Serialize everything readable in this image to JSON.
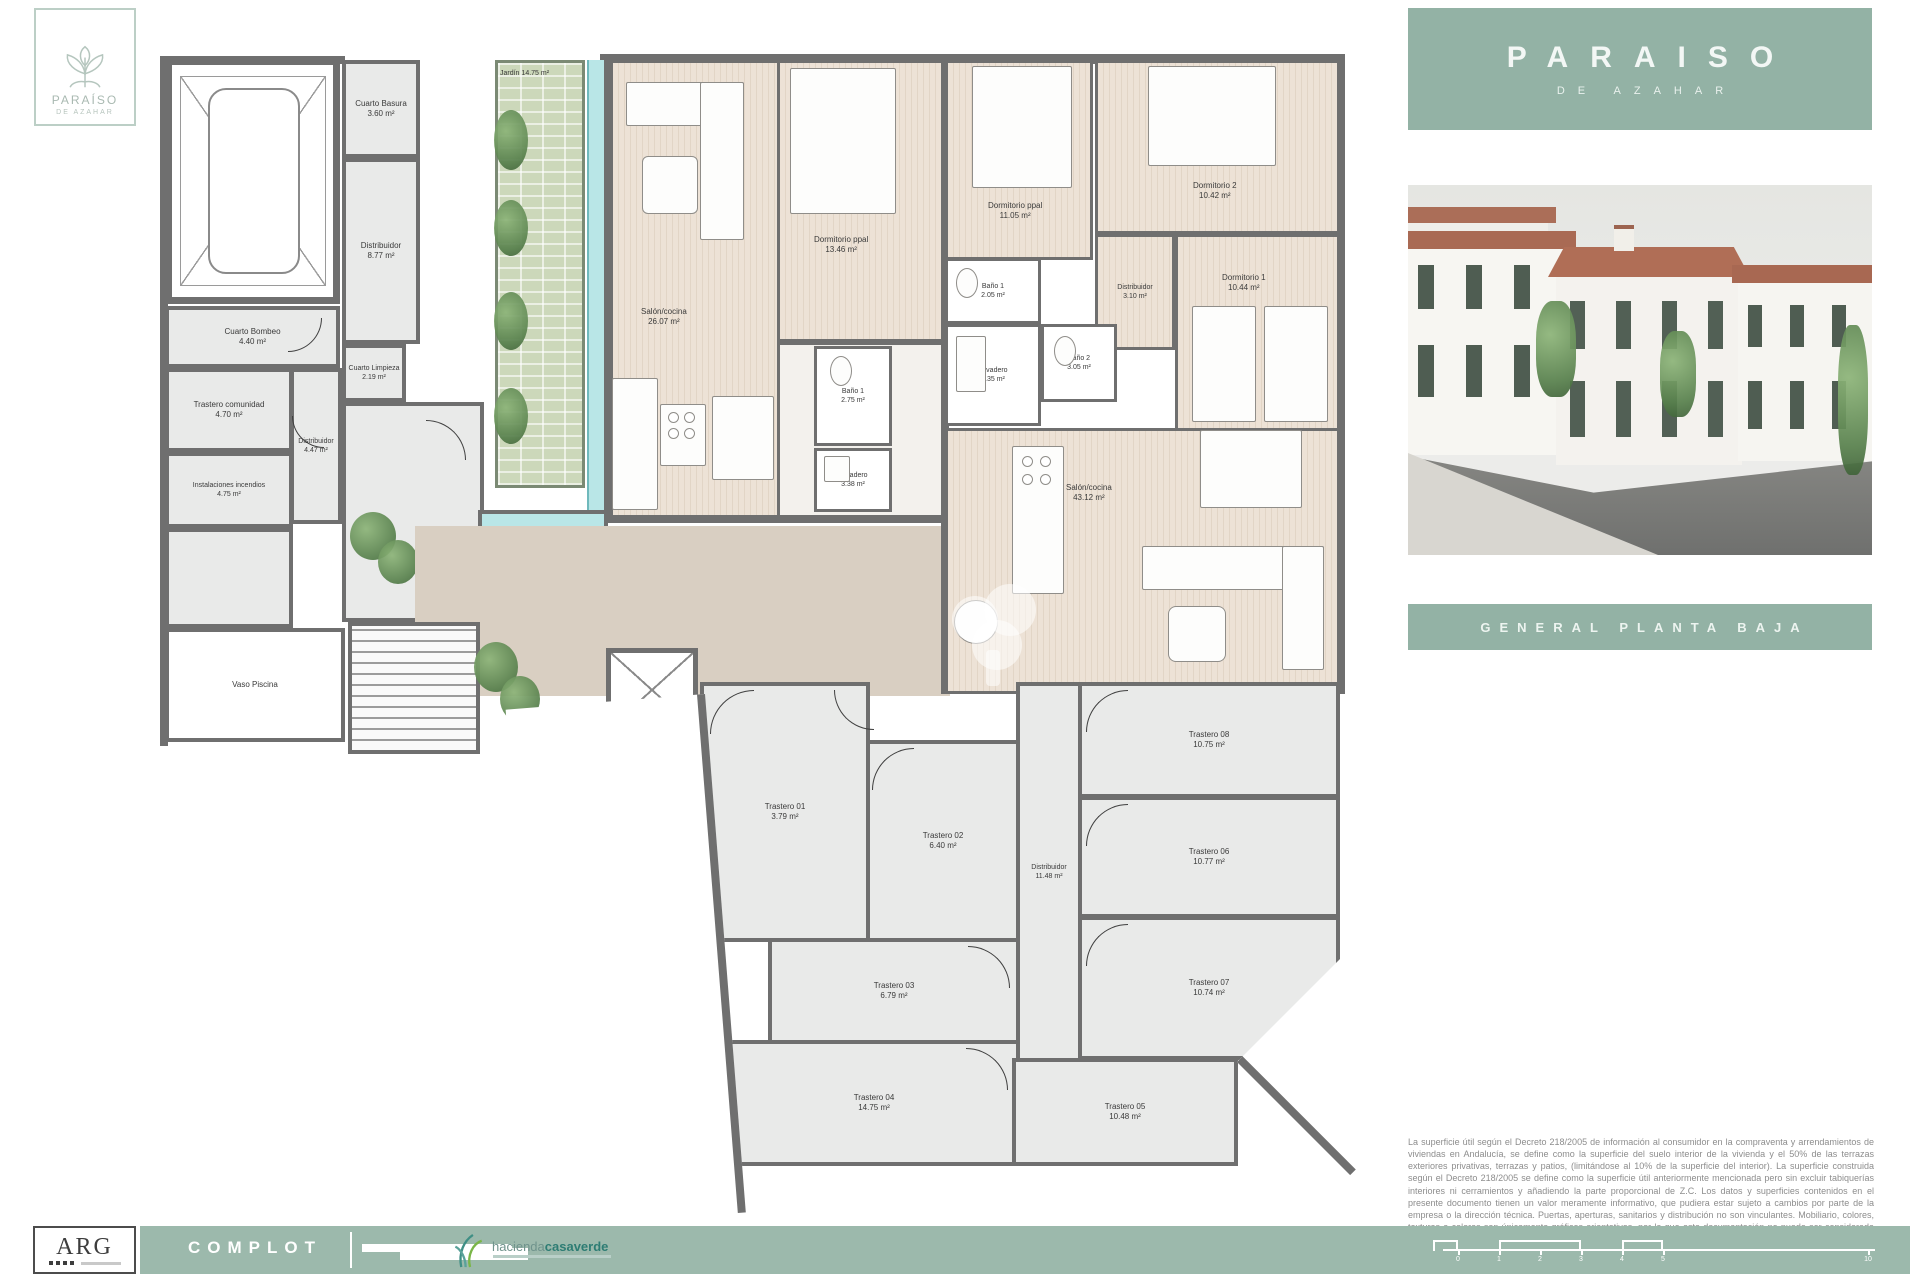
{
  "brand": {
    "logo_title": "PARAÍSO",
    "logo_subtitle": "DE AZAHAR",
    "accent_color": "#93b2a5",
    "wall_color": "#6f6f6f"
  },
  "panel": {
    "title": "PARAISO",
    "subtitle": "DE AZAHAR",
    "banner": "GENERAL PLANTA BAJA"
  },
  "plan": {
    "rooms": [
      {
        "name": "Cuarto Basura",
        "area": "3.60 m²"
      },
      {
        "name": "Distribuidor",
        "area": "8.77 m²"
      },
      {
        "name": "Cuarto Bombeo",
        "area": "4.40 m²"
      },
      {
        "name": "Trastero comunidad",
        "area": "4.70 m²"
      },
      {
        "name": "Distribuidor",
        "area": "4.47 m²"
      },
      {
        "name": "Instalaciones incendios",
        "area": "4.75 m²"
      },
      {
        "name": "Cuarto Limpieza",
        "area": "2.19 m²"
      },
      {
        "name": "Vaso Piscina",
        "area": ""
      },
      {
        "name": "Jardín",
        "area": "14.75 m²"
      },
      {
        "name": "Portal",
        "area": "35.71 m²"
      },
      {
        "name": "Salón/cocina",
        "area": "26.07 m²"
      },
      {
        "name": "Dormitorio ppal",
        "area": "13.46 m²"
      },
      {
        "name": "Baño 1",
        "area": "2.75 m²"
      },
      {
        "name": "Lavadero",
        "area": "3.38 m²"
      },
      {
        "name": "Dormitorio ppal",
        "area": "11.05 m²"
      },
      {
        "name": "Dormitorio 2",
        "area": "10.42 m²"
      },
      {
        "name": "Baño 1",
        "area": "2.05 m²"
      },
      {
        "name": "Distribuidor",
        "area": "3.10 m²"
      },
      {
        "name": "Dormitorio 1",
        "area": "10.44 m²"
      },
      {
        "name": "Lavadero",
        "area": "2.35 m²"
      },
      {
        "name": "Baño 2",
        "area": "3.05 m²"
      },
      {
        "name": "Salón/cocina",
        "area": "43.12 m²"
      },
      {
        "name": "Trastero 01",
        "area": "3.79 m²"
      },
      {
        "name": "Trastero 02",
        "area": "6.40 m²"
      },
      {
        "name": "Trastero 03",
        "area": "6.79 m²"
      },
      {
        "name": "Trastero 04",
        "area": "14.75 m²"
      },
      {
        "name": "Distribuidor",
        "area": "11.48 m²"
      },
      {
        "name": "Trastero 08",
        "area": "10.75 m²"
      },
      {
        "name": "Trastero 06",
        "area": "10.77 m²"
      },
      {
        "name": "Trastero 07",
        "area": "10.74 m²"
      },
      {
        "name": "Trastero 05",
        "area": "10.48 m²"
      }
    ]
  },
  "footer": {
    "arg": "ARG",
    "complot": "COMPLOT",
    "hacienda_light": "hacienda",
    "hacienda_bold": "casaverde",
    "scale": [
      "0",
      "1",
      "2",
      "3",
      "4",
      "5",
      "10"
    ],
    "disclaimer": "La superficie útil según el Decreto 218/2005 de información al consumidor en la compraventa y arrendamientos de viviendas en Andalucía, se define como la superficie del suelo interior de la vivienda y el 50% de las terrazas exteriores privativas, terrazas y patios, (limitándose al 10% de la superficie del interior). La superficie construida según el Decreto 218/2005 se define como la superficie útil anteriormente mencionada pero sin excluir tabiquerías interiores ni cerramientos y añadiendo la parte proporcional de Z.C. Los datos y superficies contenidos en el presente documento tienen un valor meramente informativo, que pudiera estar sujeto a cambios por parte de la empresa o la dirección técnica. Puertas, aperturas, sanitarios y distribución no son vinculantes. Mobiliario, colores, texturas e colores son únicamente gráficos orientativos, por lo que esta documentación no puede ser considerada como una forma de contrato u obligación."
  }
}
